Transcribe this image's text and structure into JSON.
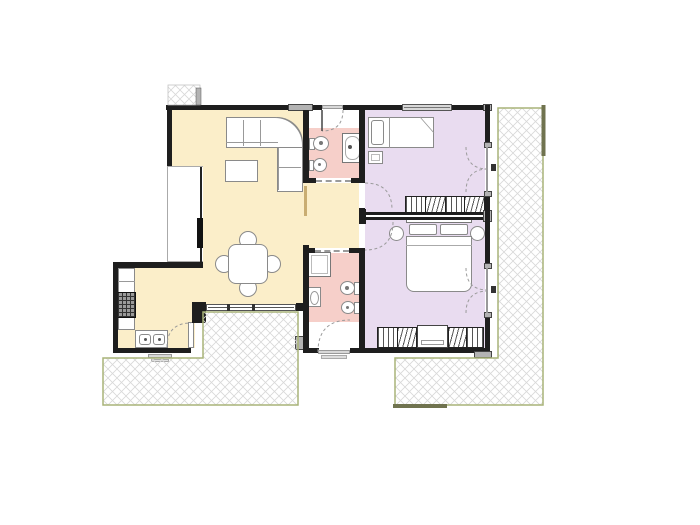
{
  "document": {
    "kind": "architectural-floor-plan",
    "title": "Two-bedroom apartment floor plan with terraces",
    "text_labels_visible": "none"
  },
  "palette": {
    "living": "#fbeec9",
    "bath": "#f6cfc9",
    "bed": "#e9dcf0",
    "wall": "#1e1e1e",
    "furn_line": "#8a8a8a",
    "block": "#b3b3b3",
    "threshold": "#d8d8d8",
    "terrace_line": "#a9b478",
    "terrace_dark": "#70734f",
    "hatch": "#d8d8d8",
    "arc": "#9b9b9b",
    "pocket": "#c9ad72"
  },
  "rooms": [
    {
      "id": "living-dining",
      "label": "Living / dining room",
      "fill": "living",
      "furniture": [
        "corner-sofa",
        "coffee-table",
        "round-dining-table",
        "four-dining-chairs"
      ]
    },
    {
      "id": "kitchen",
      "label": "Kitchen",
      "fill": "living",
      "furniture": [
        "counter-run",
        "cooktop",
        "double-sink"
      ]
    },
    {
      "id": "bathroom-1",
      "label": "Main bathroom",
      "fill": "bath",
      "fixtures": [
        "toilet",
        "bidet",
        "bathtub"
      ]
    },
    {
      "id": "entry-vestibule",
      "label": "Entry vestibule",
      "fill": "white"
    },
    {
      "id": "hallway",
      "label": "Hallway",
      "fill": "living"
    },
    {
      "id": "bathroom-2",
      "label": "Second bathroom",
      "fill": "bath",
      "fixtures": [
        "shower",
        "washbasin",
        "toilet",
        "bidet"
      ]
    },
    {
      "id": "bedroom-1",
      "label": "Single bedroom",
      "fill": "bed",
      "furniture": [
        "single-bed",
        "nightstand",
        "wardrobe"
      ]
    },
    {
      "id": "bedroom-2",
      "label": "Double bedroom",
      "fill": "bed",
      "furniture": [
        "double-bed",
        "two-nightstands",
        "two-wardrobes",
        "dresser"
      ]
    }
  ],
  "outdoor_areas": [
    {
      "id": "terrace-left",
      "label": "Paved terrace (south-west)"
    },
    {
      "id": "terrace-right",
      "label": "Paved terrace (east)"
    },
    {
      "id": "paving-patch-top",
      "label": "Paving patch at entrance side"
    }
  ],
  "openings": [
    {
      "id": "entrance-door",
      "label": "Entrance door (top wall)"
    },
    {
      "id": "bathroom-1-sliding-door",
      "label": "Sliding door to bathroom 1"
    },
    {
      "id": "bedroom-1-door",
      "label": "Bedroom 1 door"
    },
    {
      "id": "bedroom-2-door",
      "label": "Bedroom 2 door"
    },
    {
      "id": "bathroom-2-sliding-door",
      "label": "Sliding door to bathroom 2"
    },
    {
      "id": "rear-exit-door",
      "label": "Rear exit door (bottom wall)"
    },
    {
      "id": "kitchen-terrace-door",
      "label": "Kitchen door to terrace"
    },
    {
      "id": "french-door-bedroom-1",
      "label": "French door bedroom 1 to terrace"
    },
    {
      "id": "french-door-bedroom-2",
      "label": "French door bedroom 2 to terrace"
    },
    {
      "id": "living-room-window",
      "label": "Living room sliding window (west)"
    },
    {
      "id": "living-room-south-window",
      "label": "Living room window to terrace"
    },
    {
      "id": "bedroom-1-window",
      "label": "Bedroom 1 window (top wall)"
    }
  ]
}
